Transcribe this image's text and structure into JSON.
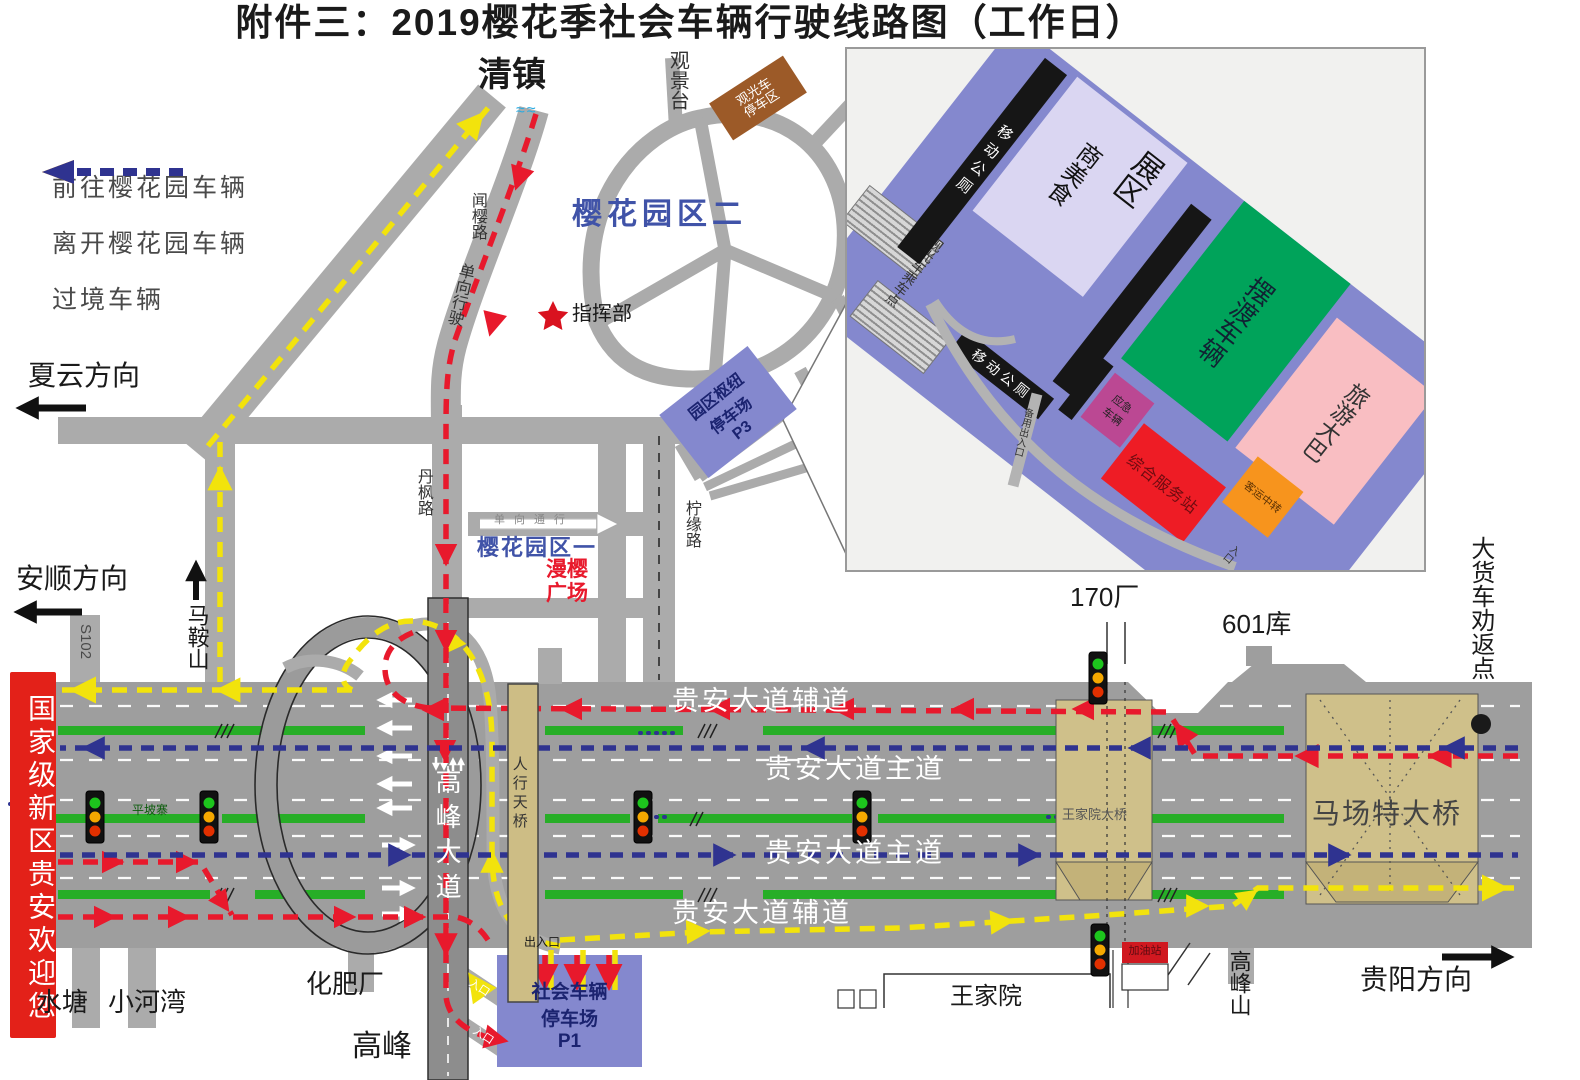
{
  "title": "附件三：2019樱花季社会车辆行驶线路图（工作日）",
  "legend": {
    "to_park": {
      "label": "前往樱花园车辆",
      "color": "#e8192c"
    },
    "leave_park": {
      "label": "离开樱花园车辆",
      "color": "#f2e30c"
    },
    "transit": {
      "label": "过境车辆",
      "color": "#2f3390"
    }
  },
  "directions": {
    "qingzhen": "清镇",
    "xiayun": "夏云方向",
    "anshun": "安顺方向",
    "guiyang": "贵阳方向"
  },
  "roads": {
    "wenying": "闻樱路",
    "oneway_drive": "单向行驶",
    "danfeng": "丹枫路",
    "maanshan": "马鞍山",
    "s102": "S102",
    "ningyuan": "柠缘路",
    "gaofeng_avenue": "高峰大道",
    "pedestrian_bridge": "人行天桥",
    "auxiliary_top": "贵安大道辅道",
    "main_top": "贵安大道主道",
    "main_bottom": "贵安大道主道",
    "auxiliary_bottom": "贵安大道辅道",
    "wangjiayuan_bridge": "王家院大桥",
    "machang_bridge": "马场特大桥",
    "oneway_pass": "单向通行"
  },
  "park": {
    "zone2": "樱花园区二",
    "zone1": "樱花园区一",
    "manying_square": "漫樱广场",
    "command_post": "指挥部",
    "viewing_platform": "观景台",
    "sightseeing_parking": "观光车停车区",
    "water_symbol": "≈≈"
  },
  "parking": {
    "p3_line1": "园区枢纽",
    "p3_line2": "停车场",
    "p3_code": "P3",
    "p1_line1": "社会车辆",
    "p1_line2": "停车场",
    "p1_code": "P1",
    "gate_inout": "出入口",
    "gate_in_upper": "入口",
    "gate_in_lower": "入口"
  },
  "places": {
    "factory_170": "170厂",
    "depot_601": "601库",
    "fertilizer_plant": "化肥厂",
    "shuitang": "水塘",
    "xiaohewan": "小河湾",
    "gaofeng": "高峰",
    "wangjiayuan": "王家院",
    "gaofengshan": "高峰山",
    "gas_station": "加油站",
    "pingpozhai": "平坡寨",
    "truck_return_point": "大货车劝返点"
  },
  "banner": "国家级新区贵安欢迎您",
  "inset": {
    "toilet_top": "移动公厕",
    "toilet_bottom": "移动公厕",
    "expo_zone": "展区",
    "expo_food": "商美食",
    "shuttle": "摆渡车辆",
    "tour_bus": "旅游大巴",
    "boarding_point": "观光车乘车点",
    "emergency": "应急车辆",
    "service_station": "综合服务站",
    "transfer": "客运中转",
    "spare_gate": "备用出入口",
    "gate": "入口"
  }
}
